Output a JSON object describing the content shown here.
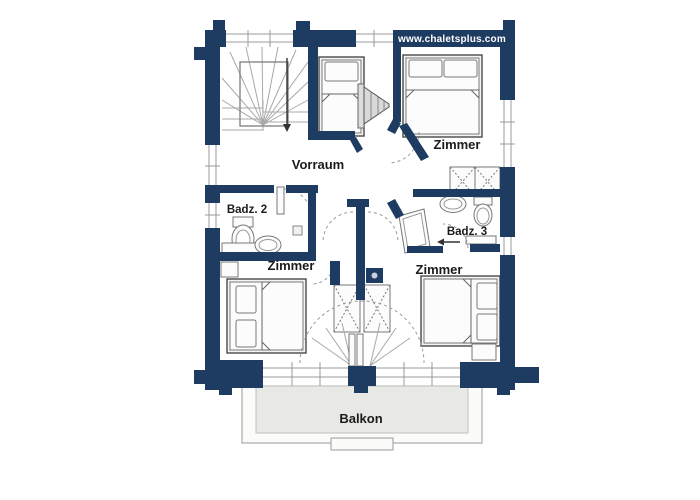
{
  "branding": {
    "website": "www.chaletsplus.com"
  },
  "rooms": {
    "vorraum": {
      "label": "Vorraum"
    },
    "zimmer_top_right": {
      "label": "Zimmer"
    },
    "badz2": {
      "label": "Badz. 2"
    },
    "badz3": {
      "label": "Badz. 3"
    },
    "zimmer_bottom_left": {
      "label": "Zimmer"
    },
    "zimmer_bottom_right": {
      "label": "Zimmer"
    },
    "balkon": {
      "label": "Balkon"
    }
  },
  "colors": {
    "wall": "#1e3c61",
    "floor": "#ffffff",
    "balcony_fill": "#e8e8e5",
    "outline": "#4a4a4a",
    "thin_line": "#9b9b9b",
    "furniture_fill": "#f4f4f2",
    "label_text": "#1b1b1b",
    "website_text": "#ffffff"
  }
}
